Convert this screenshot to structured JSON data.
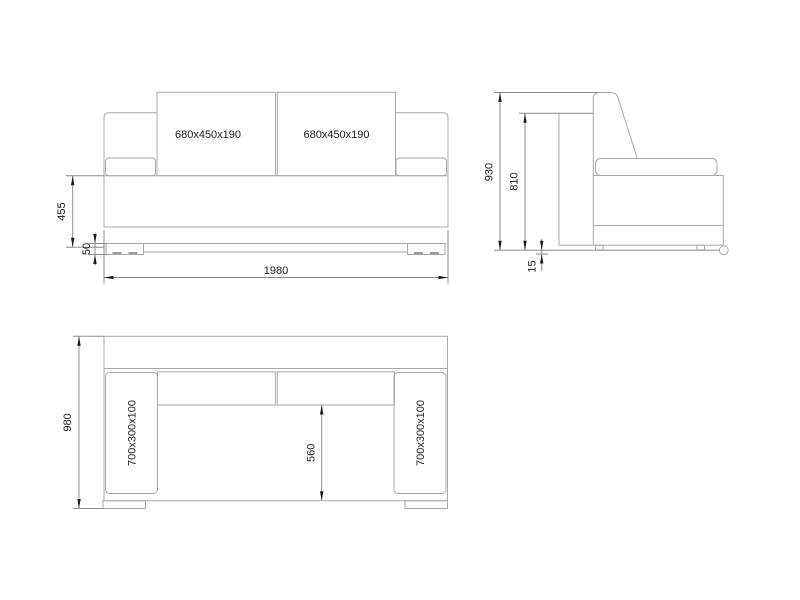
{
  "drawing": {
    "type": "furniture-dimension-drawing",
    "subject": "sofa",
    "colors": {
      "bg": "#ffffff",
      "line": "#a9a9a9",
      "dim": "#8d8d8d",
      "ink": "#1c1c1c"
    },
    "front_view": {
      "cushions": [
        {
          "label": "680x450x190"
        },
        {
          "label": "680x450x190"
        }
      ],
      "dimensions": {
        "seat_height": "455",
        "base_height": "50",
        "width": "1980"
      }
    },
    "side_view": {
      "dimensions": {
        "total_height": "930",
        "back_frame_height": "810",
        "floor_clearance": "15"
      }
    },
    "top_view": {
      "armrests": [
        {
          "label": "700x300x100"
        },
        {
          "label": "700x300x100"
        }
      ],
      "dimensions": {
        "depth": "980",
        "seat_depth": "560"
      }
    }
  }
}
